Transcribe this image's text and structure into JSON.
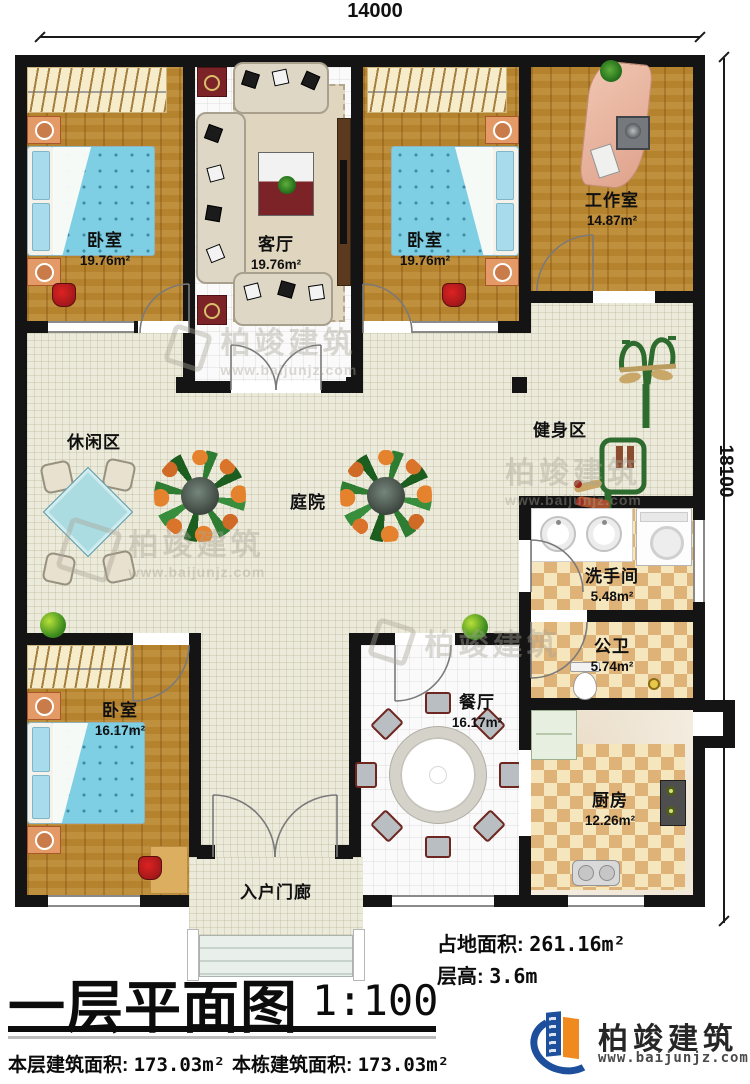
{
  "dimensions": {
    "top": "14000",
    "right": "18100"
  },
  "rooms": {
    "bedroom1": {
      "name": "卧室",
      "area": "19.76m²"
    },
    "living": {
      "name": "客厅",
      "area": "19.76m²"
    },
    "bedroom2": {
      "name": "卧室",
      "area": "19.76m²"
    },
    "workroom": {
      "name": "工作室",
      "area": "14.87m²"
    },
    "leisure": {
      "name": "休闲区"
    },
    "courtyard": {
      "name": "庭院"
    },
    "fitness": {
      "name": "健身区"
    },
    "washroom": {
      "name": "洗手间",
      "area": "5.48m²"
    },
    "publicbath": {
      "name": "公卫",
      "area": "5.74m²"
    },
    "bedroom3": {
      "name": "卧室",
      "area": "16.17m²"
    },
    "dining": {
      "name": "餐厅",
      "area": "16.17m²"
    },
    "kitchen": {
      "name": "厨房",
      "area": "12.26m²"
    },
    "porch": {
      "name": "入户门廊"
    }
  },
  "annotations": {
    "title": "一层平面图",
    "scale": "1:100",
    "land_area_label": "占地面积:",
    "land_area_value": "261.16m²",
    "floor_height_label": "层高:",
    "floor_height_value": "3.6m",
    "floor_area_label": "本层建筑面积:",
    "floor_area_value": "173.03m²",
    "building_area_label": "本栋建筑面积:",
    "building_area_value": "173.03m²"
  },
  "branding": {
    "name": "柏竣建筑",
    "site": "www.baijunjz.com"
  },
  "watermark": {
    "name": "柏竣建筑",
    "site": "www.baijunjz.com"
  },
  "colors": {
    "wall": "#141414",
    "wood": "#b5822e",
    "courtyard": "#eceadb",
    "checker": "#dfb278",
    "accent_blue": "#1d4f9c",
    "accent_orange": "#f08a1e"
  }
}
